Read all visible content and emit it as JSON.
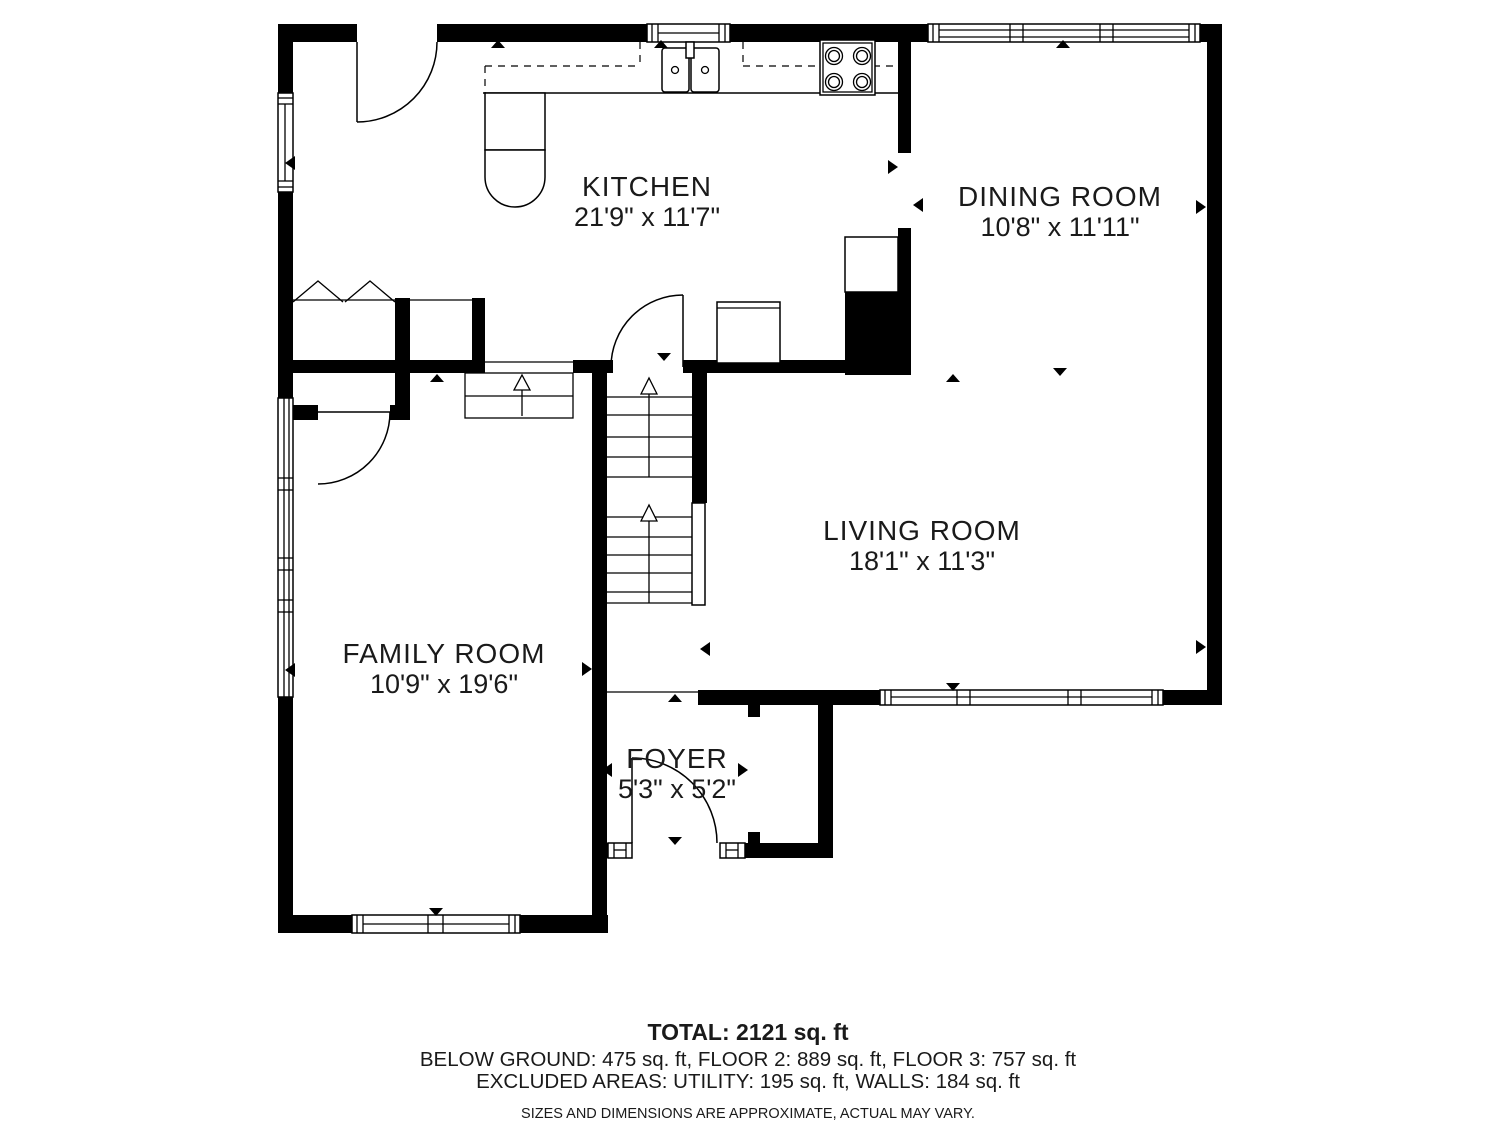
{
  "floor_plan": {
    "rooms": [
      {
        "name": "KITCHEN",
        "dimensions": "21'9\" x 11'7\""
      },
      {
        "name": "DINING ROOM",
        "dimensions": "10'8\" x 11'11\""
      },
      {
        "name": "LIVING ROOM",
        "dimensions": "18'1\" x 11'3\""
      },
      {
        "name": "FAMILY ROOM",
        "dimensions": "10'9\" x 19'6\""
      },
      {
        "name": "FOYER",
        "dimensions": "5'3\" x 5'2\""
      }
    ],
    "summary": {
      "total": "TOTAL: 2121 sq. ft",
      "floors": "BELOW GROUND: 475 sq. ft, FLOOR 2: 889 sq. ft, FLOOR 3: 757 sq. ft",
      "excluded": "EXCLUDED AREAS: UTILITY: 195 sq. ft, WALLS: 184 sq. ft",
      "disclaimer": "SIZES AND DIMENSIONS ARE APPROXIMATE, ACTUAL MAY VARY."
    },
    "colors": {
      "wall": "#000000",
      "background": "#ffffff",
      "text": "#1a1a1a"
    }
  }
}
